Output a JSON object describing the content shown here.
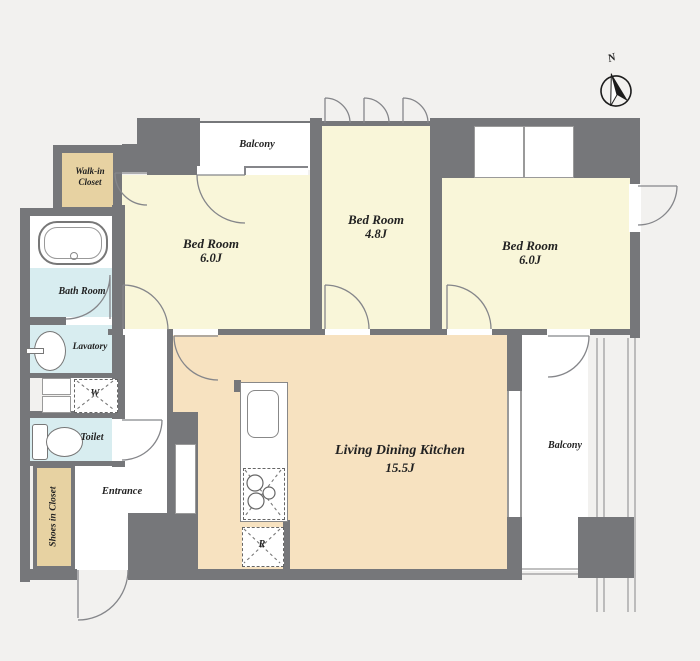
{
  "compass": {
    "north_label": "N"
  },
  "rooms": {
    "balcony_top": {
      "name": "Balcony"
    },
    "walk_in_closet": {
      "line1": "Walk-in",
      "line2": "Closet"
    },
    "bedroom_left": {
      "name": "Bed Room",
      "size": "6.0J"
    },
    "bedroom_middle": {
      "name": "Bed Room",
      "size": "4.8J"
    },
    "bedroom_right": {
      "name": "Bed Room",
      "size": "6.0J"
    },
    "bath": {
      "name": "Bath Room"
    },
    "lavatory": {
      "name": "Lavatory"
    },
    "washer": {
      "label": "W"
    },
    "toilet": {
      "name": "Toilet"
    },
    "shoes_closet": {
      "name": "Shoes in Closet"
    },
    "entrance": {
      "name": "Entrance"
    },
    "ldk": {
      "name": "Living Dining Kitchen",
      "size": "15.5J"
    },
    "refrigerator": {
      "label": "R"
    },
    "balcony_right": {
      "name": "Balcony"
    }
  },
  "colors": {
    "wall": "#76777a",
    "bedroom_floor": "#f9f6d9",
    "ldk_floor": "#f7e2c0",
    "wet_area_floor": "#d8edf0",
    "closet_floor": "#e7d2a2",
    "balcony_floor": "#ffffff",
    "background": "#f2f1ef",
    "linework": "#85868a",
    "text": "#222222"
  }
}
